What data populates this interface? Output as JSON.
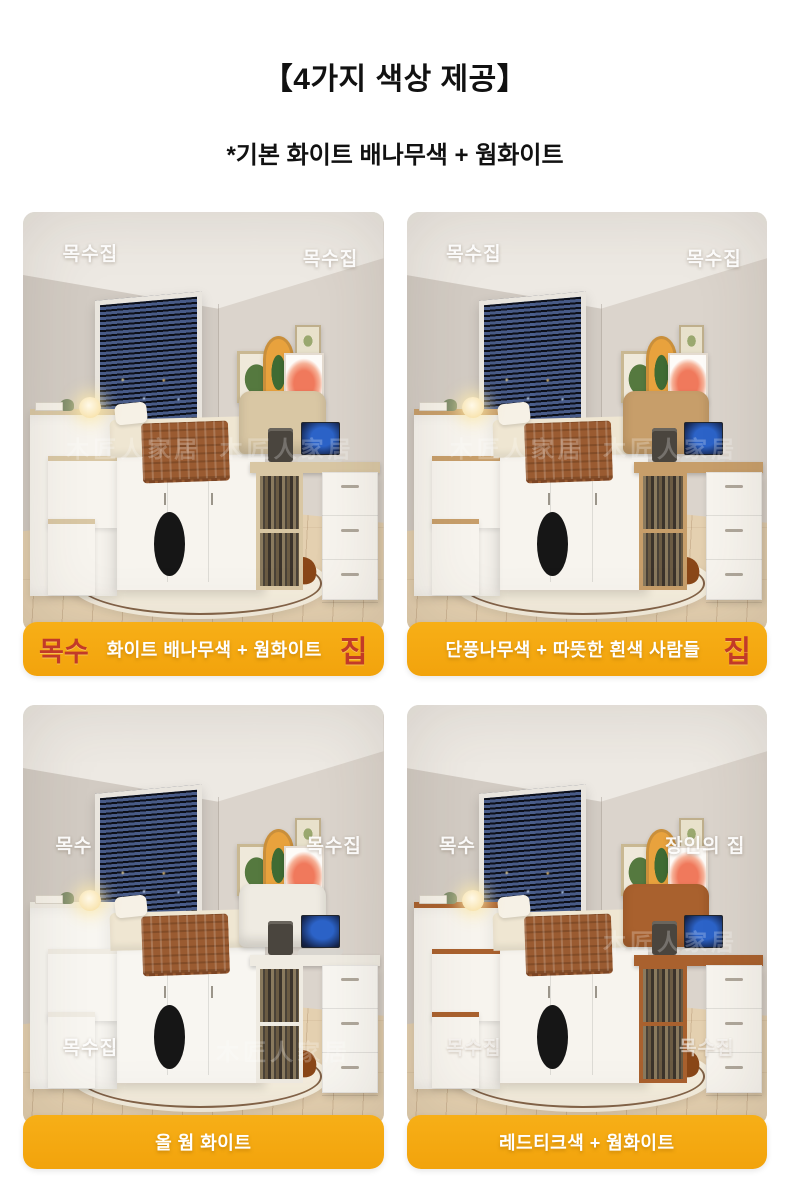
{
  "header": {
    "title": "【4가지 색상 제공】",
    "subtitle": "*기본 화이트 배나무색 + 웜화이트"
  },
  "caption_style": {
    "bar_top": "#F7AF17",
    "bar_bottom": "#F2A30C",
    "accent_red": "#C23A28",
    "text_color": "#FFFFFF"
  },
  "cards": [
    {
      "name": "white-pear-warm-white",
      "caption": {
        "prefix": "목수",
        "text": "화이트 배나무색 + 웜화이트",
        "suffix": "집"
      },
      "colors": {
        "wood": "#D9C7A4",
        "cabinet": "#F7F4EE"
      },
      "watermarks": [
        {
          "text": "목수집",
          "slot": "tl",
          "variant": "light"
        },
        {
          "text": "목수집",
          "slot": "tr",
          "variant": "light"
        },
        {
          "text": "木匠人家居",
          "slot": "ml",
          "variant": "faint"
        },
        {
          "text": "木匠人家居",
          "slot": "mr",
          "variant": "faint"
        }
      ]
    },
    {
      "name": "maple-warm-white",
      "caption": {
        "prefix": "",
        "text": "단풍나무색 + 따뜻한 흰색 사람들",
        "suffix": "집"
      },
      "colors": {
        "wood": "#C79E6A",
        "cabinet": "#F7F4EE"
      },
      "watermarks": [
        {
          "text": "목수집",
          "slot": "tl",
          "variant": "light"
        },
        {
          "text": "목수집",
          "slot": "tr",
          "variant": "light"
        },
        {
          "text": "木匠人家居",
          "slot": "ml",
          "variant": "faint"
        },
        {
          "text": "木匠人家居",
          "slot": "mr",
          "variant": "faint"
        }
      ]
    },
    {
      "name": "all-warm-white",
      "caption": {
        "prefix": "",
        "text": "올 웜 화이트",
        "suffix": ""
      },
      "colors": {
        "wood": "#EFEBE2",
        "cabinet": "#F8F6F1"
      },
      "watermarks": [
        {
          "text": "목수",
          "slot": "ul",
          "variant": "light"
        },
        {
          "text": "목수집",
          "slot": "ur",
          "variant": "light"
        },
        {
          "text": "목수집",
          "slot": "bl",
          "variant": "light"
        },
        {
          "text": "木匠人家居",
          "slot": "br",
          "variant": "faint"
        }
      ]
    },
    {
      "name": "red-teak-warm-white",
      "caption": {
        "prefix": "",
        "text": "레드티크색 + 웜화이트",
        "suffix": ""
      },
      "colors": {
        "wood": "#A9612E",
        "cabinet": "#F7F4EE"
      },
      "watermarks": [
        {
          "text": "목수",
          "slot": "ul",
          "variant": "light"
        },
        {
          "text": "장인의 집",
          "slot": "ur",
          "variant": "light"
        },
        {
          "text": "木匠人家居",
          "slot": "mr",
          "variant": "faint"
        },
        {
          "text": "목수집",
          "slot": "bl",
          "variant": "soft"
        },
        {
          "text": "목수집",
          "slot": "br",
          "variant": "soft"
        }
      ]
    }
  ]
}
